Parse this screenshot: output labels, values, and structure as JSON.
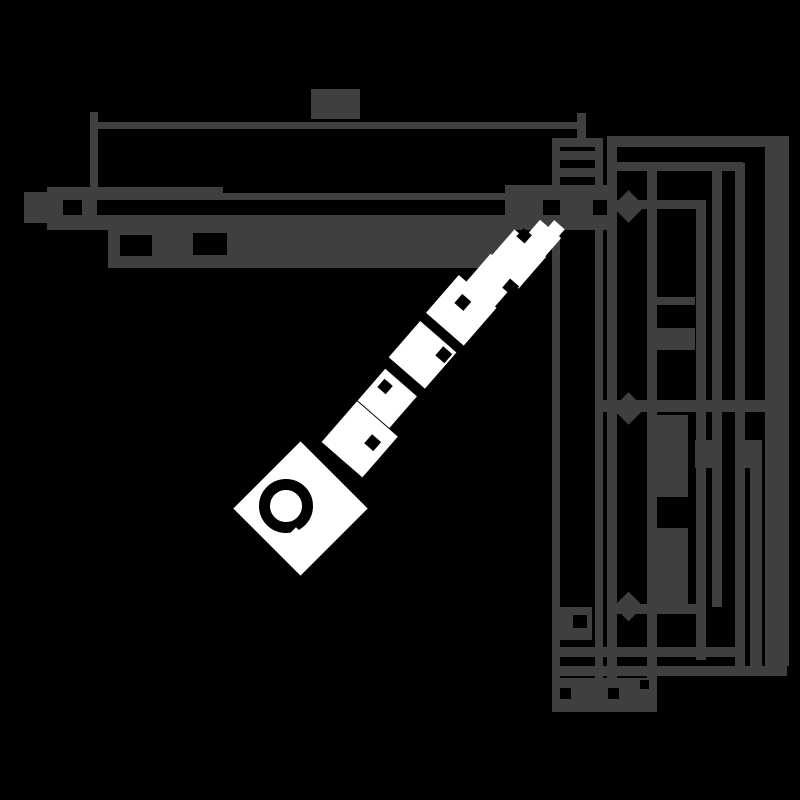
{
  "canvas": {
    "width": 800,
    "height": 800
  },
  "palette": {
    "background": "#000000",
    "line": "#3f3f3f",
    "watermark": "#ffffff"
  },
  "drawing": {
    "name": "door-closer-mounting-dimension-drawing",
    "note": "pixelated technical drawing; all dimension labels are illegible blobs",
    "rects": [
      {
        "name": "top-dim-ext-left",
        "x": 90,
        "y": 112,
        "w": 8,
        "h": 76
      },
      {
        "name": "top-dim-line",
        "x": 92,
        "y": 122,
        "w": 491,
        "h": 7
      },
      {
        "name": "top-dim-tick-right",
        "x": 577,
        "y": 113,
        "w": 9,
        "h": 27
      },
      {
        "name": "top-dim-label-blob",
        "x": 311,
        "y": 89,
        "w": 49,
        "h": 30
      },
      {
        "name": "channel-top-bar",
        "x": 48,
        "y": 187,
        "w": 175,
        "h": 13
      },
      {
        "name": "channel-top-line",
        "x": 223,
        "y": 193,
        "w": 282,
        "h": 7
      },
      {
        "name": "channel-right-block",
        "x": 505,
        "y": 185,
        "w": 102,
        "h": 45
      },
      {
        "name": "channel-end-cap",
        "x": 24,
        "y": 192,
        "w": 24,
        "h": 31
      },
      {
        "name": "channel-end-cap-step",
        "x": 24,
        "y": 212,
        "w": 29,
        "h": 11
      },
      {
        "name": "arm-end-block",
        "x": 47,
        "y": 187,
        "w": 50,
        "h": 36
      },
      {
        "name": "channel-bottom-bar",
        "x": 47,
        "y": 215,
        "w": 560,
        "h": 15
      },
      {
        "name": "arm-bar",
        "x": 108,
        "y": 228,
        "w": 407,
        "h": 40
      },
      {
        "name": "body-top-cap",
        "x": 552,
        "y": 138,
        "w": 51,
        "h": 9
      },
      {
        "name": "body-wall-left",
        "x": 552,
        "y": 147,
        "w": 8,
        "h": 565
      },
      {
        "name": "body-wall-right",
        "x": 595,
        "y": 147,
        "w": 8,
        "h": 565
      },
      {
        "name": "body-inner-line-upper",
        "x": 560,
        "y": 151,
        "w": 35,
        "h": 9
      },
      {
        "name": "body-inner-line-lower",
        "x": 560,
        "y": 168,
        "w": 35,
        "h": 9
      },
      {
        "name": "body-bottom-block",
        "x": 560,
        "y": 607,
        "w": 32,
        "h": 33
      },
      {
        "name": "frame-line-vertical",
        "x": 607,
        "y": 147,
        "w": 10,
        "h": 565
      },
      {
        "name": "right-dim-top-line",
        "x": 607,
        "y": 136,
        "w": 182,
        "h": 11
      },
      {
        "name": "right-inner-top-line",
        "x": 607,
        "y": 162,
        "w": 136,
        "h": 9
      },
      {
        "name": "frame-line-vertical-2",
        "x": 647,
        "y": 171,
        "w": 10,
        "h": 541
      },
      {
        "name": "right-dim-line-a",
        "x": 712,
        "y": 171,
        "w": 10,
        "h": 436
      },
      {
        "name": "right-dim-line-b",
        "x": 735,
        "y": 163,
        "w": 10,
        "h": 503
      },
      {
        "name": "right-dim-line-c",
        "x": 750,
        "y": 440,
        "w": 12,
        "h": 226
      },
      {
        "name": "right-dim-bar-thick",
        "x": 765,
        "y": 147,
        "w": 24,
        "h": 519
      },
      {
        "name": "hole-dim-line-top",
        "x": 607,
        "y": 200,
        "w": 99,
        "h": 9
      },
      {
        "name": "hole-dim-line-mid",
        "x": 600,
        "y": 400,
        "w": 165,
        "h": 12
      },
      {
        "name": "hole-dim-line-bottom",
        "x": 607,
        "y": 604,
        "w": 99,
        "h": 10
      },
      {
        "name": "hole-dim-ext-vertical",
        "x": 696,
        "y": 205,
        "w": 10,
        "h": 455
      },
      {
        "name": "right-dim-tick-small",
        "x": 655,
        "y": 297,
        "w": 40,
        "h": 8
      },
      {
        "name": "right-dim-label-blob-a",
        "x": 655,
        "y": 328,
        "w": 40,
        "h": 22
      },
      {
        "name": "right-dim-label-blob-b",
        "x": 655,
        "y": 415,
        "w": 33,
        "h": 82
      },
      {
        "name": "right-dim-label-blob-c",
        "x": 655,
        "y": 528,
        "w": 33,
        "h": 77
      },
      {
        "name": "right-dim-label-blob-d",
        "x": 695,
        "y": 440,
        "w": 23,
        "h": 28
      },
      {
        "name": "right-dim-label-blob-e",
        "x": 737,
        "y": 440,
        "w": 23,
        "h": 28
      },
      {
        "name": "bottom-line-upper",
        "x": 552,
        "y": 647,
        "w": 193,
        "h": 10
      },
      {
        "name": "bottom-line-lower",
        "x": 552,
        "y": 666,
        "w": 235,
        "h": 10
      },
      {
        "name": "bottom-label-blob",
        "x": 552,
        "y": 678,
        "w": 103,
        "h": 34
      }
    ],
    "hole_markers": [
      {
        "name": "mount-hole-marker-top",
        "cx": 628,
        "cy": 206,
        "size": 23
      },
      {
        "name": "mount-hole-marker-middle",
        "cx": 628,
        "cy": 408,
        "size": 23
      },
      {
        "name": "mount-hole-marker-bottom",
        "cx": 628,
        "cy": 606,
        "size": 21
      }
    ],
    "holes": [
      {
        "name": "arm-end-hole",
        "x": 63,
        "y": 200,
        "w": 19,
        "h": 15
      },
      {
        "name": "arm-bar-hole-left",
        "x": 120,
        "y": 235,
        "w": 32,
        "h": 21
      },
      {
        "name": "arm-bar-hole-right",
        "x": 193,
        "y": 233,
        "w": 34,
        "h": 22
      },
      {
        "name": "channel-gap-left",
        "x": 543,
        "y": 200,
        "w": 17,
        "h": 15
      },
      {
        "name": "channel-gap-right",
        "x": 593,
        "y": 200,
        "w": 14,
        "h": 15
      },
      {
        "name": "body-bottom-hole",
        "x": 573,
        "y": 615,
        "w": 14,
        "h": 13
      },
      {
        "name": "bottom-label-hole-a",
        "x": 560,
        "y": 688,
        "w": 11,
        "h": 11
      },
      {
        "name": "bottom-label-hole-b",
        "x": 608,
        "y": 688,
        "w": 11,
        "h": 11
      },
      {
        "name": "bottom-label-hole-c",
        "x": 640,
        "y": 680,
        "w": 9,
        "h": 9
      }
    ]
  },
  "watermark": {
    "name": "diagonal-watermark",
    "note": "white pixelated watermark: diamond logo with ring, illegible blob lettering rising to upper right",
    "angle_deg": -49,
    "origin": {
      "x": 300,
      "y": 508
    },
    "logo": {
      "size": 95,
      "ring": {
        "cx": 286,
        "cy": 506,
        "diameter": 54,
        "stroke": 11,
        "gap_x": 296,
        "gap_y": 540,
        "gap_size": 18
      }
    },
    "letter_blobs": [
      {
        "offset": 91,
        "dy": 0,
        "size": 54
      },
      {
        "offset": 140,
        "dy": -6,
        "size": 42
      },
      {
        "offset": 196,
        "dy": -8,
        "size": 48
      },
      {
        "offset": 255,
        "dy": -8,
        "size": 50
      },
      {
        "offset": 298,
        "dy": -4,
        "size": 38
      },
      {
        "offset": 330,
        "dy": 0,
        "size": 42
      },
      {
        "offset": 361,
        "dy": 6,
        "size": 28
      },
      {
        "offset": 377,
        "dy": 10,
        "size": 14
      }
    ],
    "notches": [
      {
        "offset": 97,
        "dy": 12,
        "size": 12
      },
      {
        "offset": 147,
        "dy": -16,
        "size": 11
      },
      {
        "offset": 210,
        "dy": 8,
        "size": 12
      },
      {
        "offset": 262,
        "dy": -12,
        "size": 12
      },
      {
        "offset": 305,
        "dy": 14,
        "size": 12
      },
      {
        "offset": 352,
        "dy": -10,
        "size": 11
      }
    ]
  }
}
